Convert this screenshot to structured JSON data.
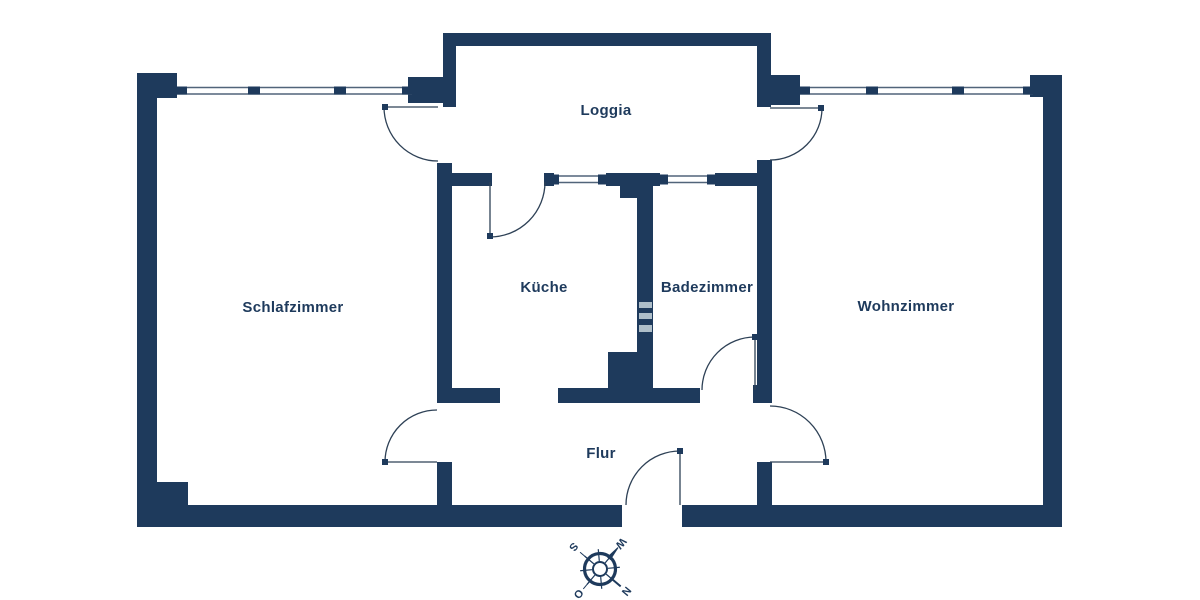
{
  "floorplan": {
    "rooms": {
      "loggia": "Loggia",
      "schlafzimmer": "Schlafzimmer",
      "kueche": "Küche",
      "badezimmer": "Badezimmer",
      "wohnzimmer": "Wohnzimmer",
      "flur": "Flur"
    },
    "compass": {
      "north": "N",
      "east": "O",
      "south": "S",
      "west": "W"
    },
    "colors": {
      "wall": "#1E3A5C",
      "background": "#FFFFFF",
      "window_line": "#51647A",
      "door_line": "#2E4156",
      "shaft_marks": "#AEBEC9"
    }
  }
}
